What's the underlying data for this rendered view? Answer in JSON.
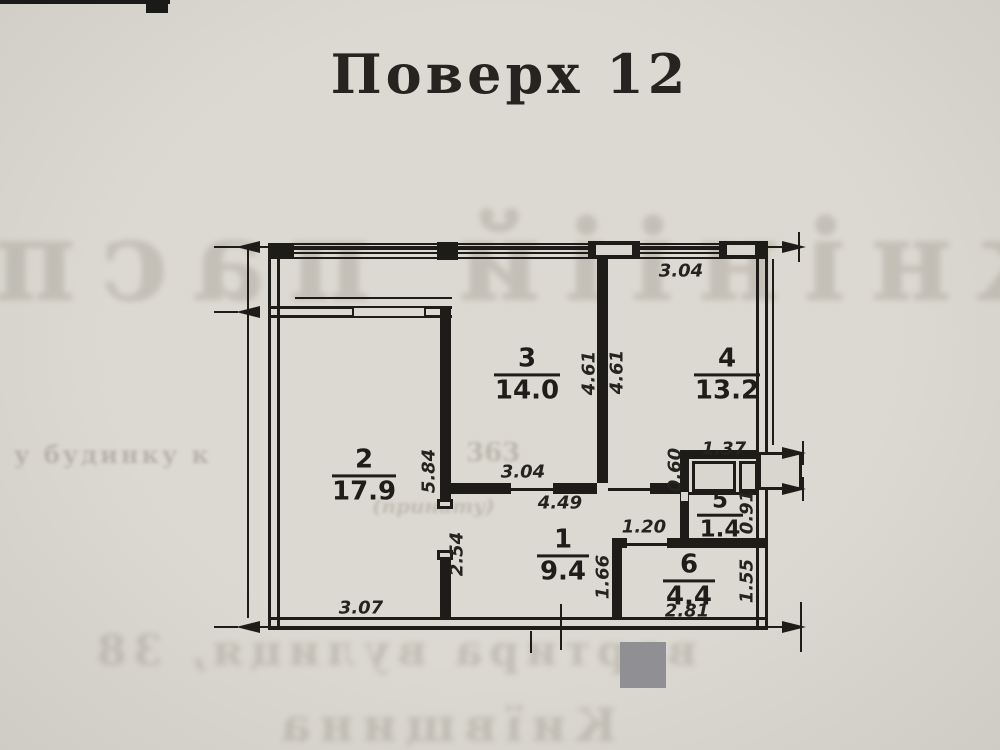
{
  "page": {
    "title": "Поверх 12"
  },
  "plan": {
    "rooms": {
      "r1": {
        "number": "1",
        "area": "9.4"
      },
      "r2": {
        "number": "2",
        "area": "17.9"
      },
      "r3": {
        "number": "3",
        "area": "14.0"
      },
      "r4": {
        "number": "4",
        "area": "13.2"
      },
      "r5": {
        "number": "5",
        "area": "1.4"
      },
      "r6": {
        "number": "6",
        "area": "4.4"
      }
    },
    "dims": {
      "top_width": "3.04",
      "room3_width": "3.04",
      "hall_width": "4.49",
      "room2_height": "5.84",
      "room3_height": "4.61",
      "room4_height": "4.61",
      "shaft_width": "1.37",
      "shaft_height": "0.60",
      "wc_height": "0.91",
      "hall6_width": "1.20",
      "room6_left_height": "1.66",
      "room6_right_height": "1.55",
      "room6_width": "2.81",
      "hall_left_height": "2.54",
      "room2_width": "3.07"
    },
    "bleedthrough": {
      "top": "кнініій пасп",
      "mid1": "у будинку к",
      "mid2": "363",
      "mid3": "(принату)",
      "bottom1": "вартира вулиця, 38",
      "bottom2": "Київщина"
    }
  }
}
